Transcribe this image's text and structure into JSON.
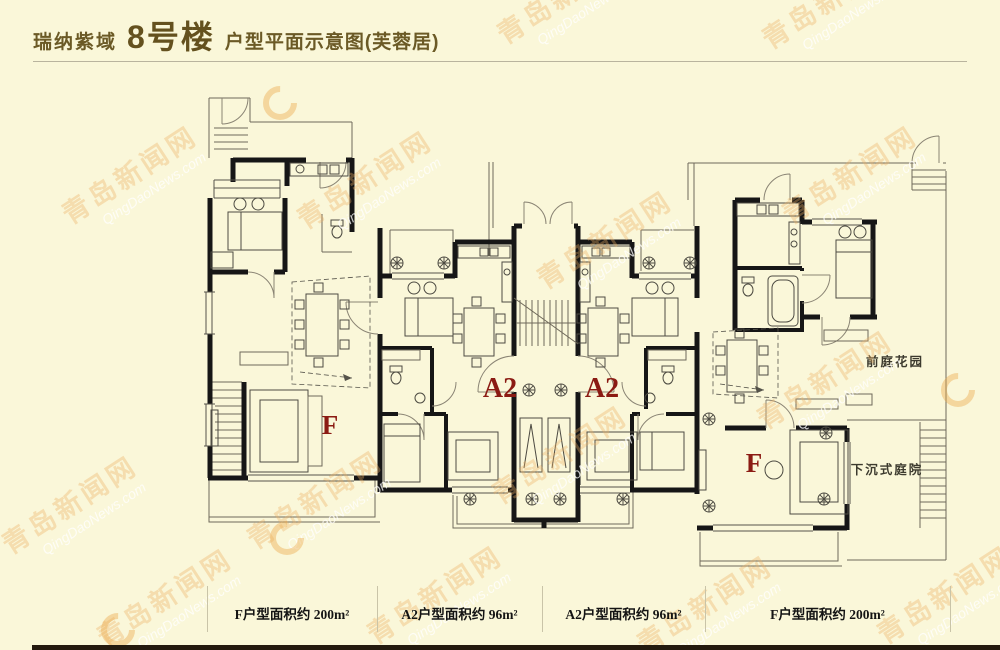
{
  "page": {
    "title": {
      "project": "瑞纳紫域",
      "building": "8号楼",
      "suffix": "户型平面示意图(芙蓉居)"
    },
    "watermark": {
      "cn": "青岛新闻网",
      "en": "QingDaoNews.com"
    }
  },
  "plan": {
    "units": [
      {
        "label": "F",
        "area_label": "F户型面积约 200m²"
      },
      {
        "label": "A2",
        "area_label": "A2户型面积约 96m²"
      },
      {
        "label": "A2",
        "area_label": "A2户型面积约 96m²"
      },
      {
        "label": "F",
        "area_label": "F户型面积约 200m²"
      }
    ],
    "annotations": {
      "front_garden": "前庭花园",
      "sunken_yard": "下沉式庭院"
    }
  },
  "colors": {
    "background": "#faf7d9",
    "wall": "#161616",
    "accent_red": "#8b1b13",
    "title_brown": "#6b5a26",
    "footer_bar": "#241a0e",
    "watermark_orange": "#ecb062"
  }
}
